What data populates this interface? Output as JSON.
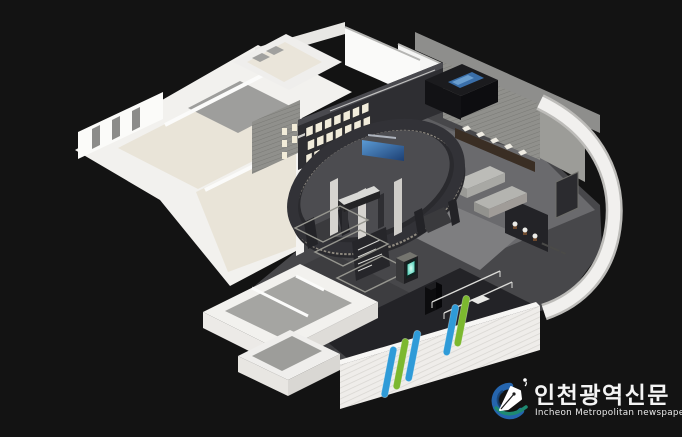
{
  "image": {
    "description": "Isometric 3D architectural rendering of a museum / exhibition hall interior floor plan on a black background",
    "background_color": "#131313"
  },
  "palette": {
    "bg": "#131313",
    "hall_floor": "#47474a",
    "hall_floor_dark": "#232327",
    "wall_white": "#f2f1ee",
    "floor_beige": "#e9e4d8",
    "floor_gray": "#a5a5a2",
    "wood": "#90908c",
    "dark_wall": "#2e2e32",
    "fin_blue": "#2f9bd8",
    "fin_green": "#7cb82f",
    "screen_blue": "#2e6db0",
    "glow_teal": "#63d6c0"
  },
  "watermark": {
    "brand_korean": "인천광역신문",
    "brand_english": "Incheon Metropolitan newspaper",
    "icon": "pen-nib-swirl-icon",
    "colors": {
      "swirl_blue": "#2565ae",
      "swoosh_teal": "#1e8a72",
      "nib_white": "#ffffff"
    }
  },
  "scene": {
    "regions": [
      {
        "name": "storage-rooms-top-left",
        "floor": "beige and white"
      },
      {
        "name": "empty-gallery-left",
        "floor": "beige"
      },
      {
        "name": "main-exhibition-hall",
        "floor": "dark gray"
      },
      {
        "name": "central-oval-exhibit",
        "feature": "curved dark media wall with blue screen and wood base"
      },
      {
        "name": "picture-frame-wall",
        "frames": 17
      },
      {
        "name": "artifact-showcase-right",
        "items": "small white artifacts in dark cases"
      },
      {
        "name": "curved-white-perimeter-wall",
        "sign": "illegible small dark lettering"
      },
      {
        "name": "facade-with-glass-fins",
        "fins": [
          "blue",
          "green",
          "blue",
          "blue",
          "green"
        ]
      },
      {
        "name": "service-rooms-bottom-left",
        "floor": "gray"
      },
      {
        "name": "floor-tape-markings",
        "count": 3
      }
    ]
  }
}
